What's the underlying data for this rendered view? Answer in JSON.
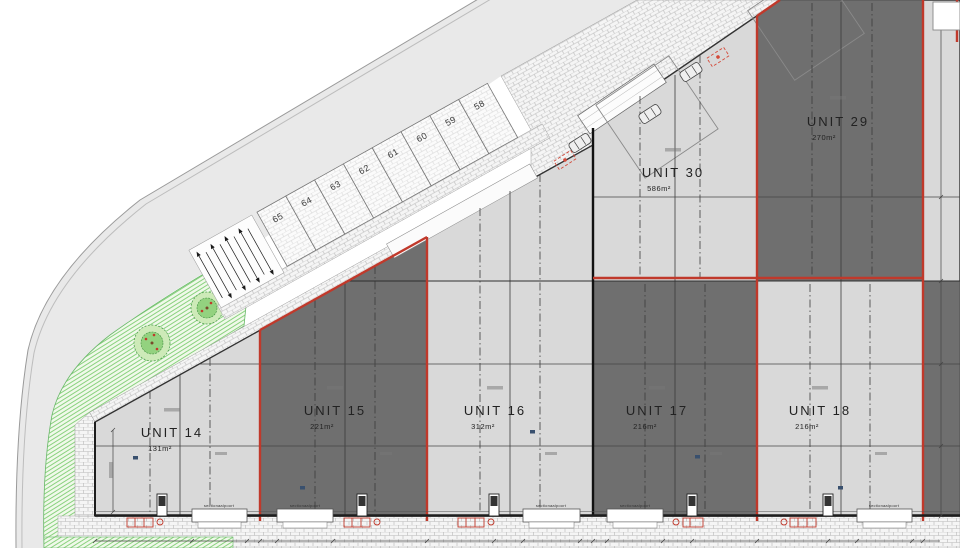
{
  "drawing": {
    "units": [
      {
        "name": "UNIT 14",
        "area": "131m²",
        "shade": "light"
      },
      {
        "name": "UNIT 15",
        "area": "221m²",
        "shade": "dark"
      },
      {
        "name": "UNIT 16",
        "area": "312m²",
        "shade": "light"
      },
      {
        "name": "UNIT 17",
        "area": "216m²",
        "shade": "dark"
      },
      {
        "name": "UNIT 18",
        "area": "216m²",
        "shade": "light"
      },
      {
        "name": "UNIT 29",
        "area": "270m²",
        "shade": "dark"
      },
      {
        "name": "UNIT 30",
        "area": "586m²",
        "shade": "light"
      }
    ],
    "parking_spaces": [
      "58",
      "59",
      "60",
      "61",
      "62",
      "63",
      "64",
      "65"
    ],
    "door_label": "sectionaalpoort",
    "colors": {
      "unit_light": "#d9d9d9",
      "unit_dark": "#6f6f6f",
      "boundary_red": "#c0392b",
      "landscape_green": "#7fcf78",
      "road_gray": "#e9e9e9"
    }
  }
}
